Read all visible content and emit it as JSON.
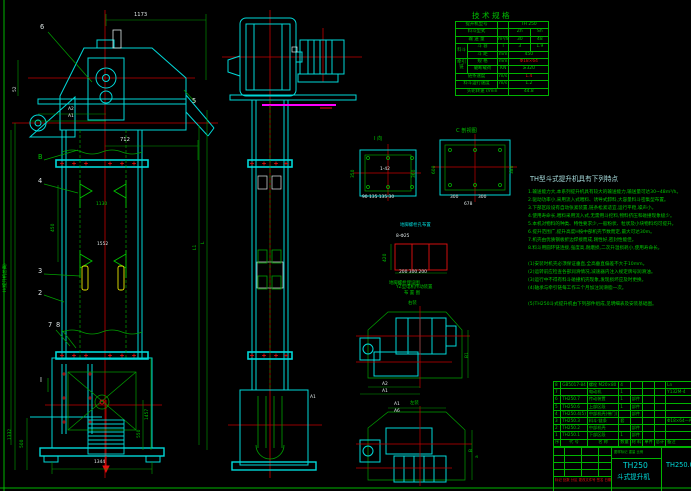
{
  "tech_table": {
    "title": "技 术 规 格",
    "rows": [
      {
        "label": "提升机型号",
        "unit": "",
        "v1": "TH 250",
        "v2": ""
      },
      {
        "label": "料斗型式",
        "unit": "",
        "v1": "Zh",
        "v2": "Sh"
      },
      {
        "label": "输 送 量",
        "unit": "m³/h",
        "v1": "30",
        "v2": "48"
      },
      {
        "group": "料斗",
        "label": "斗 容",
        "unit": "l",
        "v1": "3",
        "v2": "1.9"
      },
      {
        "label2": "斗 距",
        "unit": "mm",
        "v1": "450"
      },
      {
        "group2": "牵引链",
        "label": "规 格",
        "unit": "mm",
        "v1": "Φ18×64"
      },
      {
        "label2": "破断载荷",
        "unit": "KN",
        "v1": "≥320"
      },
      {
        "label": "链条速度",
        "unit": "m/s",
        "v1": "1.4"
      },
      {
        "label": "料斗运行速度",
        "unit": "m/s",
        "v1": "1.2"
      },
      {
        "label": "头轮转速 r/min",
        "v1": "44.8"
      }
    ]
  },
  "notes": {
    "heading": "TH型斗式提升机具有下列特点",
    "items": [
      "1.输送能力大,本系列提升机具有较大的输送能力,输送量可达30~48m³/h。",
      "2.驱动功率小,采用流入式喂料、诱导式卸料,大容量料斗密集型布置。",
      "3.下部区段设有自动张紧装置,链条松紧适宜,运行平稳,噪声小。",
      "4.使用寿命长,喂料采用流入式,无需用斗挖料,物料挤压和碰撞现象极少。",
      "5.本机对物料的种类、特性要求少,一般粉状、粒状及小块物料均可提升。",
      "6.提升范围广,提升高度H按中部机壳节数而定,最大可达30m。",
      "7.机壳由优质钢板折边焊接而成,刚性好,密封性能佳。",
      "8.料斗用圆环链连接,强度高,耐磨损,二次升温损耗小,使用寿命长。"
    ],
    "sub_items": [
      "(1)安装时机壳必须保证垂直,全高垂直偏差不大于10mm。",
      "(2)运转前应检查各部润滑情况,减速器内注入规定牌号润滑油。",
      "(3)运行中不得有料斗碰撞机壳现象,发现损坏应及时更换。",
      "(4)轴承与牵引链每工作三个月加注润滑脂一次。"
    ],
    "footer": "(5)TH250斗式提升机由下列部件组成,见明细表及安装基础图。"
  },
  "bom": {
    "headers": {
      "no": "序",
      "code": "代  号",
      "name": "名  称",
      "qty": "数量",
      "material": "材 料",
      "w1": "单件",
      "w2": "总计",
      "note": "备注"
    },
    "rows": [
      {
        "no": "8",
        "code": "GB5017-84",
        "name": "螺栓 M20×80",
        "qty": "4",
        "material": "",
        "note": "Ln"
      },
      {
        "no": "7",
        "code": "",
        "name": "电动机",
        "qty": "1",
        "material": "",
        "note": "Y132M-4"
      },
      {
        "no": "6",
        "code": "TH250.7",
        "name": "传动装置",
        "qty": "1",
        "material": "部件",
        "note": ""
      },
      {
        "no": "5",
        "code": "TH250.6",
        "name": "上部区段",
        "qty": "1",
        "material": "部件",
        "note": ""
      },
      {
        "no": "4",
        "code": "TH250.4(5)",
        "name": "中部机壳(带门)",
        "qty": "",
        "material": "部件",
        "note": ""
      },
      {
        "no": "3",
        "code": "TH250.3",
        "name": "料斗·链条",
        "qty": "套",
        "material": "",
        "note": "Φ18×64—A"
      },
      {
        "no": "2",
        "code": "TH250.2",
        "name": "中部机壳",
        "qty": "",
        "material": "部件",
        "note": ""
      },
      {
        "no": "1",
        "code": "TH250.1",
        "name": "下部区段",
        "qty": "1",
        "material": "部件",
        "note": ""
      }
    ]
  },
  "title_block": {
    "model": "TH250",
    "product": "斗式提升机",
    "drawing_no": "TH250.0",
    "rev_line": "标记 处数 分区 更改文件号 签名 日期",
    "scale_line": "图样标记  重量  比例"
  },
  "labels": {
    "p1": "1",
    "p2": "2",
    "p3": "3",
    "p4": "4",
    "p5": "5",
    "p6": "6",
    "p7": "7",
    "p8": "8",
    "B": "B",
    "I": "Ⅰ",
    "sec1": "Ⅰ 向",
    "sec2": "C 剖视图",
    "anchor_top": "地脚螺栓孔布置",
    "anchor_caption": "地脚螺栓埋设图",
    "plat_title1": "YZ型电机传动装置",
    "plat_title2": "布 置 图",
    "plat_up": "右装",
    "plat_low": "左装"
  },
  "dims": {
    "d1173": "1173",
    "d52": "52",
    "dA2": "A2",
    "dA1": "A1",
    "d712": "712",
    "d450": "450",
    "d1130": "1130",
    "d1552": "1552",
    "dH": "H(提升机总高)",
    "dL1": "L1",
    "dL": "L",
    "d1332": "1332",
    "d500": "500",
    "d1344": "1344",
    "d1457": "1457",
    "d550": "550",
    "mA1": "A1",
    "s1_left": "350",
    "s1_right": "360",
    "s1_bottom": "90 135 135 30",
    "s1_center": "1-42",
    "s2_left": "600",
    "s2_right": "380",
    "s2_b1": "300",
    "s2_b2": "300",
    "s2_total": "678",
    "an_bolt": "8-Φ25",
    "an_left": "420",
    "an_bottom": "200 300 200",
    "pu_A2": "A2",
    "pu_A1": "A1",
    "pu_B1": "B1",
    "pl_A1": "A1",
    "pl_A6": "A6",
    "pl_B": "B",
    "pl_a": "a"
  }
}
